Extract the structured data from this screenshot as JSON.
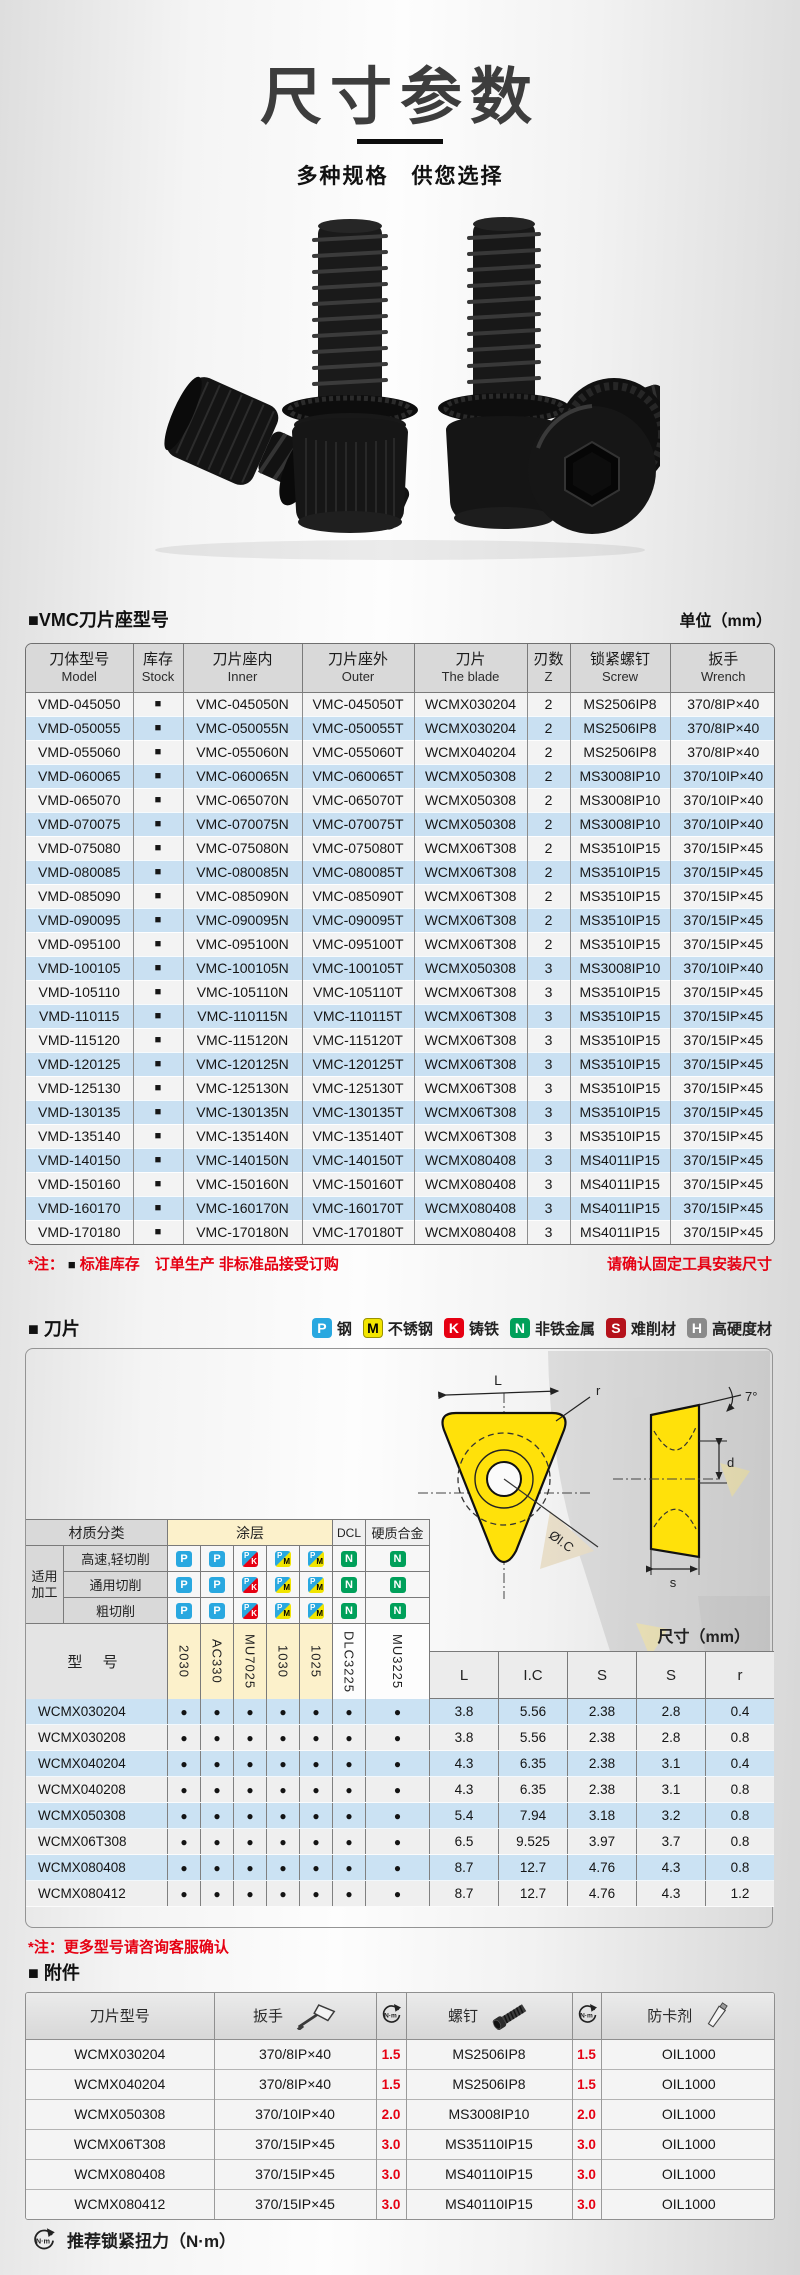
{
  "page": {
    "title": "尺寸参数",
    "subtitle": "多种规格　供您选择"
  },
  "colors": {
    "accent_red": "#e60012",
    "row_blue": "#c9e0f2",
    "header_gray": "#d9d9d9",
    "coating_yellow": "#fcf1cb",
    "badge_p": "#29a8e0",
    "badge_m": "#f2e500",
    "badge_k": "#e60012",
    "badge_n": "#00a05a",
    "badge_s": "#b5121b",
    "badge_h": "#8a8a8a"
  },
  "icons": {
    "stock": "■",
    "dot": "●",
    "torque": "circular-arrow-N·m",
    "wrench": "torx-driver",
    "screw": "cap-screw",
    "tube": "grease-tube"
  },
  "holder": {
    "heading": "■VMC刀片座型号",
    "unit": "单位（mm）",
    "columns": [
      {
        "zh": "刀体型号",
        "en": "Model"
      },
      {
        "zh": "库存",
        "en": "Stock"
      },
      {
        "zh": "刀片座内",
        "en": "Inner"
      },
      {
        "zh": "刀片座外",
        "en": "Outer"
      },
      {
        "zh": "刀片",
        "en": "The blade"
      },
      {
        "zh": "刃数",
        "en": "Z"
      },
      {
        "zh": "锁紧螺钉",
        "en": "Screw"
      },
      {
        "zh": "扳手",
        "en": "Wrench"
      }
    ],
    "rows": [
      [
        "VMD-045050",
        "■",
        "VMC-045050N",
        "VMC-045050T",
        "WCMX030204",
        "2",
        "MS2506IP8",
        "370/8IP×40"
      ],
      [
        "VMD-050055",
        "■",
        "VMC-050055N",
        "VMC-050055T",
        "WCMX030204",
        "2",
        "MS2506IP8",
        "370/8IP×40"
      ],
      [
        "VMD-055060",
        "■",
        "VMC-055060N",
        "VMC-055060T",
        "WCMX040204",
        "2",
        "MS2506IP8",
        "370/8IP×40"
      ],
      [
        "VMD-060065",
        "■",
        "VMC-060065N",
        "VMC-060065T",
        "WCMX050308",
        "2",
        "MS3008IP10",
        "370/10IP×40"
      ],
      [
        "VMD-065070",
        "■",
        "VMC-065070N",
        "VMC-065070T",
        "WCMX050308",
        "2",
        "MS3008IP10",
        "370/10IP×40"
      ],
      [
        "VMD-070075",
        "■",
        "VMC-070075N",
        "VMC-070075T",
        "WCMX050308",
        "2",
        "MS3008IP10",
        "370/10IP×40"
      ],
      [
        "VMD-075080",
        "■",
        "VMC-075080N",
        "VMC-075080T",
        "WCMX06T308",
        "2",
        "MS3510IP15",
        "370/15IP×45"
      ],
      [
        "VMD-080085",
        "■",
        "VMC-080085N",
        "VMC-080085T",
        "WCMX06T308",
        "2",
        "MS3510IP15",
        "370/15IP×45"
      ],
      [
        "VMD-085090",
        "■",
        "VMC-085090N",
        "VMC-085090T",
        "WCMX06T308",
        "2",
        "MS3510IP15",
        "370/15IP×45"
      ],
      [
        "VMD-090095",
        "■",
        "VMC-090095N",
        "VMC-090095T",
        "WCMX06T308",
        "2",
        "MS3510IP15",
        "370/15IP×45"
      ],
      [
        "VMD-095100",
        "■",
        "VMC-095100N",
        "VMC-095100T",
        "WCMX06T308",
        "2",
        "MS3510IP15",
        "370/15IP×45"
      ],
      [
        "VMD-100105",
        "■",
        "VMC-100105N",
        "VMC-100105T",
        "WCMX050308",
        "3",
        "MS3008IP10",
        "370/10IP×40"
      ],
      [
        "VMD-105110",
        "■",
        "VMC-105110N",
        "VMC-105110T",
        "WCMX06T308",
        "3",
        "MS3510IP15",
        "370/15IP×45"
      ],
      [
        "VMD-110115",
        "■",
        "VMC-110115N",
        "VMC-110115T",
        "WCMX06T308",
        "3",
        "MS3510IP15",
        "370/15IP×45"
      ],
      [
        "VMD-115120",
        "■",
        "VMC-115120N",
        "VMC-115120T",
        "WCMX06T308",
        "3",
        "MS3510IP15",
        "370/15IP×45"
      ],
      [
        "VMD-120125",
        "■",
        "VMC-120125N",
        "VMC-120125T",
        "WCMX06T308",
        "3",
        "MS3510IP15",
        "370/15IP×45"
      ],
      [
        "VMD-125130",
        "■",
        "VMC-125130N",
        "VMC-125130T",
        "WCMX06T308",
        "3",
        "MS3510IP15",
        "370/15IP×45"
      ],
      [
        "VMD-130135",
        "■",
        "VMC-130135N",
        "VMC-130135T",
        "WCMX06T308",
        "3",
        "MS3510IP15",
        "370/15IP×45"
      ],
      [
        "VMD-135140",
        "■",
        "VMC-135140N",
        "VMC-135140T",
        "WCMX06T308",
        "3",
        "MS3510IP15",
        "370/15IP×45"
      ],
      [
        "VMD-140150",
        "■",
        "VMC-140150N",
        "VMC-140150T",
        "WCMX080408",
        "3",
        "MS4011IP15",
        "370/15IP×45"
      ],
      [
        "VMD-150160",
        "■",
        "VMC-150160N",
        "VMC-150160T",
        "WCMX080408",
        "3",
        "MS4011IP15",
        "370/15IP×45"
      ],
      [
        "VMD-160170",
        "■",
        "VMC-160170N",
        "VMC-160170T",
        "WCMX080408",
        "3",
        "MS4011IP15",
        "370/15IP×45"
      ],
      [
        "VMD-170180",
        "■",
        "VMC-170180N",
        "VMC-170180T",
        "WCMX080408",
        "3",
        "MS4011IP15",
        "370/15IP×45"
      ]
    ],
    "note_prefix": "*注：",
    "note_square": "■",
    "note_text": "标准库存　订单生产 非标准品接受订购",
    "note_right": "请确认固定工具安装尺寸"
  },
  "insert": {
    "heading": "■ 刀片",
    "legend": [
      {
        "code": "P",
        "label": "钢"
      },
      {
        "code": "M",
        "label": "不锈钢"
      },
      {
        "code": "K",
        "label": "铸铁"
      },
      {
        "code": "N",
        "label": "非铁金属"
      },
      {
        "code": "S",
        "label": "难削材"
      },
      {
        "code": "H",
        "label": "高硬度材"
      }
    ],
    "class_header": {
      "material": "材质分类",
      "coating": "涂层",
      "dcl": "DCL",
      "carbide": "硬质合金"
    },
    "apply_line1": "适用",
    "apply_line2": "加工",
    "cut_rows": [
      {
        "label": "高速,轻切削",
        "icons": [
          "P",
          "P",
          "PK",
          "PM",
          "PM",
          "N",
          "N"
        ]
      },
      {
        "label": "通用切削",
        "icons": [
          "P",
          "P",
          "PK",
          "PM",
          "PM",
          "N",
          "N"
        ]
      },
      {
        "label": "粗切削",
        "icons": [
          "P",
          "P",
          "PK",
          "PM",
          "PM",
          "N",
          "N"
        ]
      }
    ],
    "model_label": "型 号",
    "coat_columns": [
      {
        "name": "2030",
        "tint": "yellow"
      },
      {
        "name": "AC330",
        "tint": "yellow"
      },
      {
        "name": "MU7025",
        "tint": "yellow"
      },
      {
        "name": "1030",
        "tint": "yellow"
      },
      {
        "name": "1025",
        "tint": "yellow"
      },
      {
        "name": "DLC3225",
        "tint": "plain"
      },
      {
        "name": "MU3225",
        "tint": "plain"
      }
    ],
    "size_label": "尺寸（mm）",
    "dim_columns": [
      "L",
      "I.C",
      "S",
      "S",
      "r"
    ],
    "drawing_labels": {
      "length": "L",
      "radius": "r",
      "inscribed": "ØI.C",
      "angle": "7°",
      "d": "d",
      "s": "s"
    },
    "rows": [
      {
        "model": "WCMX030204",
        "dots": [
          1,
          1,
          1,
          1,
          1,
          1,
          1
        ],
        "dims": [
          "3.8",
          "5.56",
          "2.38",
          "2.8",
          "0.4"
        ]
      },
      {
        "model": "WCMX030208",
        "dots": [
          1,
          1,
          1,
          1,
          1,
          1,
          1
        ],
        "dims": [
          "3.8",
          "5.56",
          "2.38",
          "2.8",
          "0.8"
        ]
      },
      {
        "model": "WCMX040204",
        "dots": [
          1,
          1,
          1,
          1,
          1,
          1,
          1
        ],
        "dims": [
          "4.3",
          "6.35",
          "2.38",
          "3.1",
          "0.4"
        ]
      },
      {
        "model": "WCMX040208",
        "dots": [
          1,
          1,
          1,
          1,
          1,
          1,
          1
        ],
        "dims": [
          "4.3",
          "6.35",
          "2.38",
          "3.1",
          "0.8"
        ]
      },
      {
        "model": "WCMX050308",
        "dots": [
          1,
          1,
          1,
          1,
          1,
          1,
          1
        ],
        "dims": [
          "5.4",
          "7.94",
          "3.18",
          "3.2",
          "0.8"
        ]
      },
      {
        "model": "WCMX06T308",
        "dots": [
          1,
          1,
          1,
          1,
          1,
          1,
          1
        ],
        "dims": [
          "6.5",
          "9.525",
          "3.97",
          "3.7",
          "0.8"
        ]
      },
      {
        "model": "WCMX080408",
        "dots": [
          1,
          1,
          1,
          1,
          1,
          1,
          1
        ],
        "dims": [
          "8.7",
          "12.7",
          "4.76",
          "4.3",
          "0.8"
        ]
      },
      {
        "model": "WCMX080412",
        "dots": [
          1,
          1,
          1,
          1,
          1,
          1,
          1
        ],
        "dims": [
          "8.7",
          "12.7",
          "4.76",
          "4.3",
          "1.2"
        ]
      }
    ],
    "note": "*注：更多型号请咨询客服确认"
  },
  "accessories": {
    "heading": "■ 附件",
    "columns": [
      "刀片型号",
      "扳手",
      "N·m",
      "螺钉",
      "N·m",
      "防卡剂"
    ],
    "rows": [
      [
        "WCMX030204",
        "370/8IP×40",
        "1.5",
        "MS2506IP8",
        "1.5",
        "OIL1000"
      ],
      [
        "WCMX040204",
        "370/8IP×40",
        "1.5",
        "MS2506IP8",
        "1.5",
        "OIL1000"
      ],
      [
        "WCMX050308",
        "370/10IP×40",
        "2.0",
        "MS3008IP10",
        "2.0",
        "OIL1000"
      ],
      [
        "WCMX06T308",
        "370/15IP×45",
        "3.0",
        "MS35110IP15",
        "3.0",
        "OIL1000"
      ],
      [
        "WCMX080408",
        "370/15IP×45",
        "3.0",
        "MS40110IP15",
        "3.0",
        "OIL1000"
      ],
      [
        "WCMX080412",
        "370/15IP×45",
        "3.0",
        "MS40110IP15",
        "3.0",
        "OIL1000"
      ]
    ],
    "footnote": "推荐锁紧扭力（N·m）",
    "torque_label": "N·m"
  }
}
